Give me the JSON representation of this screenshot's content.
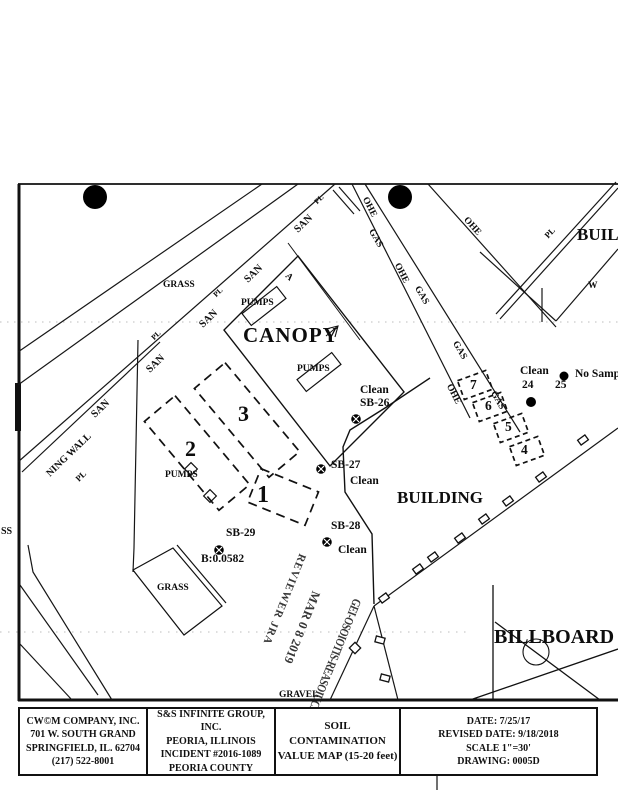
{
  "colors": {
    "ink": "#111111",
    "paper": "#ffffff"
  },
  "map": {
    "labels": {
      "grass_top": "GRASS",
      "grass_lower": "GRASS",
      "canopy": "CANOPY",
      "pumps": "PUMPS",
      "san": "SAN",
      "pl": "PL",
      "ohe": "OHE",
      "gas": "GAS",
      "a_marker": "A",
      "w_marker": "W",
      "ss": "SS",
      "ning_wall": "NING WALL",
      "building_main": "BUILDING",
      "building_upper": "BUILDING",
      "billboard": "BILLBOARD",
      "gravel": "GRAVEL",
      "box1": "1",
      "box2": "2",
      "box3": "3",
      "box4": "4",
      "box5": "5",
      "box6": "6",
      "box7": "7",
      "clean": "Clean",
      "sb26": "SB-26",
      "sb27": "SB-27",
      "sb28": "SB-28",
      "sb29": "SB-29",
      "b_value": "B:0.0582",
      "pt24": "24",
      "pt25": "25",
      "no_sample": "No Samp"
    },
    "stamp": {
      "line1": "REVIEWER JRA",
      "line2": "MAR 0 8 2019",
      "line3": "GEI-OSOIOTIS-REASOIUCE"
    }
  },
  "title_block": {
    "cells": [
      {
        "lines": [
          "CW©M COMPANY, INC.",
          "701 W. SOUTH GRAND",
          "SPRINGFIELD, IL. 62704",
          "(217) 522-8001"
        ]
      },
      {
        "lines": [
          "S&S INFINITE GROUP, INC.",
          "PEORIA, ILLINOIS",
          "INCIDENT #2016-1089",
          "PEORIA COUNTY"
        ]
      },
      {
        "lines": [
          "SOIL CONTAMINATION",
          "VALUE MAP (15-20 feet)"
        ]
      },
      {
        "lines": [
          "DATE: 7/25/17",
          "REVISED DATE: 9/18/2018",
          "SCALE 1\"=30'",
          "DRAWING: 0005D"
        ]
      }
    ]
  }
}
